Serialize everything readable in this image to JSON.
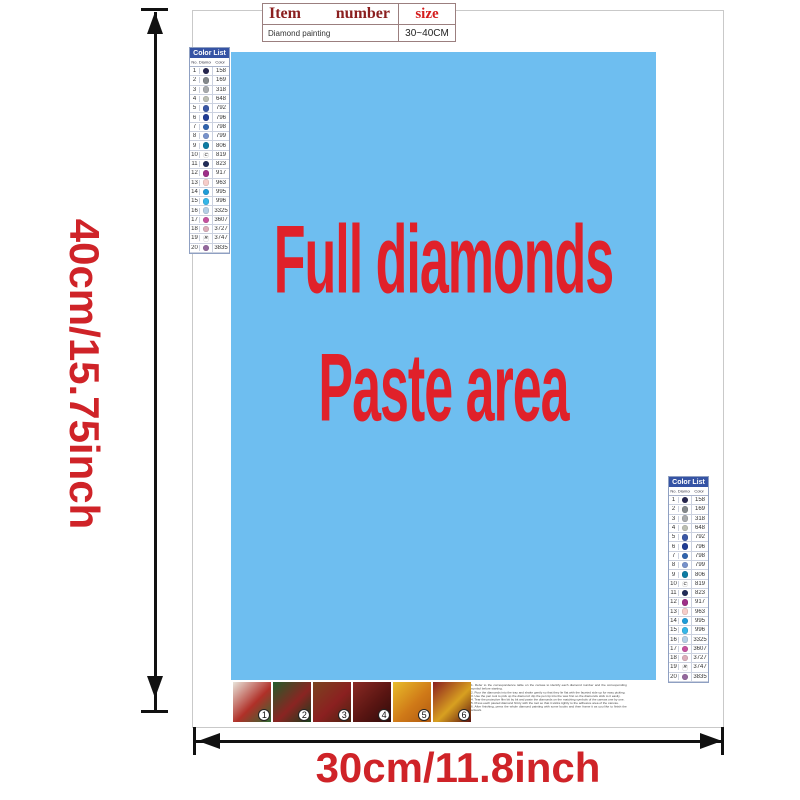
{
  "colors": {
    "paste_bg": "#6ebef0",
    "paste_text": "#e0212a",
    "dim_text": "#cf2328",
    "list_header_bg": "#3553a4"
  },
  "dimensions": {
    "height_label": "40cm/15.75inch",
    "width_label": "30cm/11.8inch"
  },
  "spec_table": {
    "col_item": "Item",
    "col_number": "number",
    "col_size": "size",
    "row_item": "Diamond painting",
    "row_size": "30~40CM"
  },
  "paste_area": {
    "line1": "Full diamonds",
    "line2": "Paste area"
  },
  "color_list": {
    "title": "Color List",
    "columns": [
      "No.",
      "Diamond",
      "Color"
    ],
    "rows": [
      {
        "no": "1",
        "sym": "",
        "symc": "#ffffff",
        "hex": "#26264f",
        "code": "158"
      },
      {
        "no": "2",
        "sym": "",
        "symc": "#ffffff",
        "hex": "#84898c",
        "code": "169"
      },
      {
        "no": "3",
        "sym": "",
        "symc": "#ffffff",
        "hex": "#a8abad",
        "code": "318"
      },
      {
        "no": "4",
        "sym": "",
        "symc": "#ffffff",
        "hex": "#bcbfb3",
        "code": "648"
      },
      {
        "no": "5",
        "sym": "",
        "symc": "#ffffff",
        "hex": "#3a57a5",
        "code": "792"
      },
      {
        "no": "6",
        "sym": "",
        "symc": "#ffffff",
        "hex": "#203c94",
        "code": "796"
      },
      {
        "no": "7",
        "sym": "",
        "symc": "#ffffff",
        "hex": "#2f63ae",
        "code": "798"
      },
      {
        "no": "8",
        "sym": "",
        "symc": "#ffffff",
        "hex": "#7792cc",
        "code": "799"
      },
      {
        "no": "9",
        "sym": "",
        "symc": "#ffffff",
        "hex": "#0e7ca3",
        "code": "806"
      },
      {
        "no": "10",
        "sym": "C",
        "symc": "#555555",
        "hex": "#ffffff",
        "code": "819"
      },
      {
        "no": "11",
        "sym": "",
        "symc": "#ffffff",
        "hex": "#202c58",
        "code": "823"
      },
      {
        "no": "12",
        "sym": "",
        "symc": "#ffffff",
        "hex": "#9e2f88",
        "code": "917"
      },
      {
        "no": "13",
        "sym": "",
        "symc": "#555555",
        "hex": "#f6cdc9",
        "code": "963"
      },
      {
        "no": "14",
        "sym": "",
        "symc": "#ffffff",
        "hex": "#1f9cd8",
        "code": "995"
      },
      {
        "no": "15",
        "sym": "",
        "symc": "#ffffff",
        "hex": "#35b6e8",
        "code": "996"
      },
      {
        "no": "16",
        "sym": "",
        "symc": "#555555",
        "hex": "#b4cfe6",
        "code": "3325"
      },
      {
        "no": "17",
        "sym": "",
        "symc": "#ffffff",
        "hex": "#c6519f",
        "code": "3607"
      },
      {
        "no": "18",
        "sym": "",
        "symc": "#555555",
        "hex": "#dcaeba",
        "code": "3727"
      },
      {
        "no": "19",
        "sym": "R",
        "symc": "#555555",
        "hex": "#ffffff",
        "code": "3747"
      },
      {
        "no": "20",
        "sym": "",
        "symc": "#ffffff",
        "hex": "#94689d",
        "code": "3835"
      }
    ]
  },
  "accessories": {
    "items": [
      {
        "num": "1",
        "g1": "#e8e4da",
        "g2": "#b03028",
        "g3": "#2f6b34"
      },
      {
        "num": "2",
        "g1": "#245c2a",
        "g2": "#8a2422",
        "g3": "#173f1c"
      },
      {
        "num": "3",
        "g1": "#7a4420",
        "g2": "#8b2020",
        "g3": "#4a2410"
      },
      {
        "num": "4",
        "g1": "#8a2a24",
        "g2": "#5a1512",
        "g3": "#2f0c0a"
      },
      {
        "num": "5",
        "g1": "#e8bc2a",
        "g2": "#d07a18",
        "g3": "#b05a10"
      },
      {
        "num": "6",
        "g1": "#8b1f1f",
        "g2": "#d8a020",
        "g3": "#5a1210"
      }
    ]
  },
  "instructions": {
    "lines": [
      {
        "t": "1. Refer to the correspondence table on the canvas to identify each diamond number and the corresponding symbol before starting."
      },
      {
        "t": "2. Pour the diamonds into the tray and shake gently so that they lie flat with the faceted side up for easy picking."
      },
      {
        "t": "3. Use the pen tool to pick up the diamond: dip the pen tip into the wax first so the diamonds stick to it easily."
      },
      {
        "t": "4. Tear the protective film bit by bit and paste the diamonds on the matching symbols of the canvas one by one."
      },
      {
        "t": "5. Press each pasted diamond firmly with the tool so that it sticks tightly to the adhesive area of the canvas."
      },
      {
        "t": "6. After finishing, press the whole diamond painting with some books and then frame it as you like to finish the artwork."
      }
    ]
  }
}
